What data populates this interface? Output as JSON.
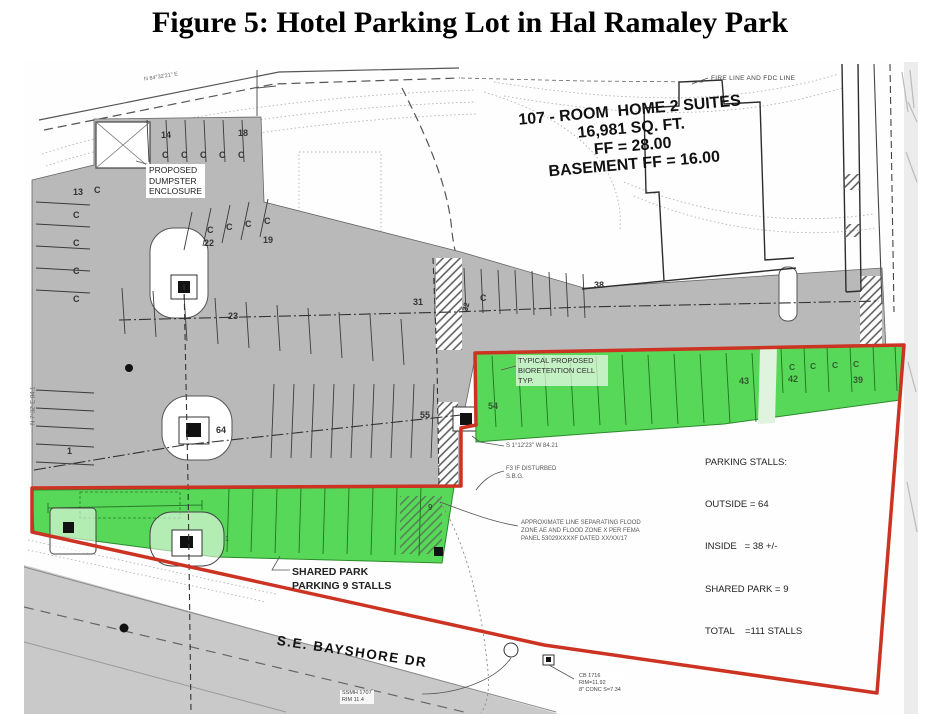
{
  "figure": {
    "title": "Figure 5: Hotel Parking Lot in Hal Ramaley Park"
  },
  "building": {
    "line1": "107 - ROOM  HOME 2 SUITES",
    "line2": "16,981 SQ. FT.",
    "line3": "FF = 28.00",
    "line4": "BASEMENT FF = 16.00"
  },
  "notes": {
    "fire_line": "FIRE LINE AND FDC LINE",
    "dumpster": [
      "PROPOSED",
      "DUMPSTER",
      "ENCLOSURE"
    ],
    "bioretention": [
      "TYPICAL PROPOSED",
      "BIORETENTION CELL",
      "TYP."
    ],
    "parking_summary": [
      "PARKING STALLS:",
      "OUTSIDE = 64",
      "INSIDE   = 38 +/-",
      "SHARED PARK = 9",
      "TOTAL    =111 STALLS"
    ],
    "shared_park": [
      "SHARED PARK",
      "PARKING 9 STALLS"
    ],
    "flood_zone": [
      "APPROXIMATE LINE SEPARATING FLOOD",
      "ZONE AE AND FLOOD ZONE X PER FEMA",
      "PANEL 53029XXXXF DATED XX/XX/17"
    ],
    "street": "S.E. BAYSHORE DR",
    "catch_basin": [
      "CB 1716",
      "RIM=11.92",
      "8\" CONC S=7.34"
    ],
    "manhole": [
      "SSMH 1707",
      "RIM 11.4"
    ],
    "bearing_right": "S 1°12'23\" W  84.21",
    "if_disturbed": [
      "F3 IF DISTURBED",
      "S.B.G."
    ],
    "bearing_left": "N 7°32' E  84.1",
    "bearing_top": "N 84°32'21\" E"
  },
  "stalls": {
    "n1": "1",
    "n9": "9",
    "n13": "13",
    "n14": "14",
    "n18": "18",
    "n19": "19",
    "n22": "22",
    "n23": "23",
    "n31": "31",
    "n32": "32",
    "n38": "38",
    "n39": "39",
    "n42": "42",
    "n43": "43",
    "n54": "54",
    "n55": "55",
    "n64": "64",
    "c": "C"
  },
  "colors": {
    "shared_park_green": "#58d858",
    "property_boundary_red": "#cc3322",
    "pavement_gray": "#b9b9b9"
  }
}
